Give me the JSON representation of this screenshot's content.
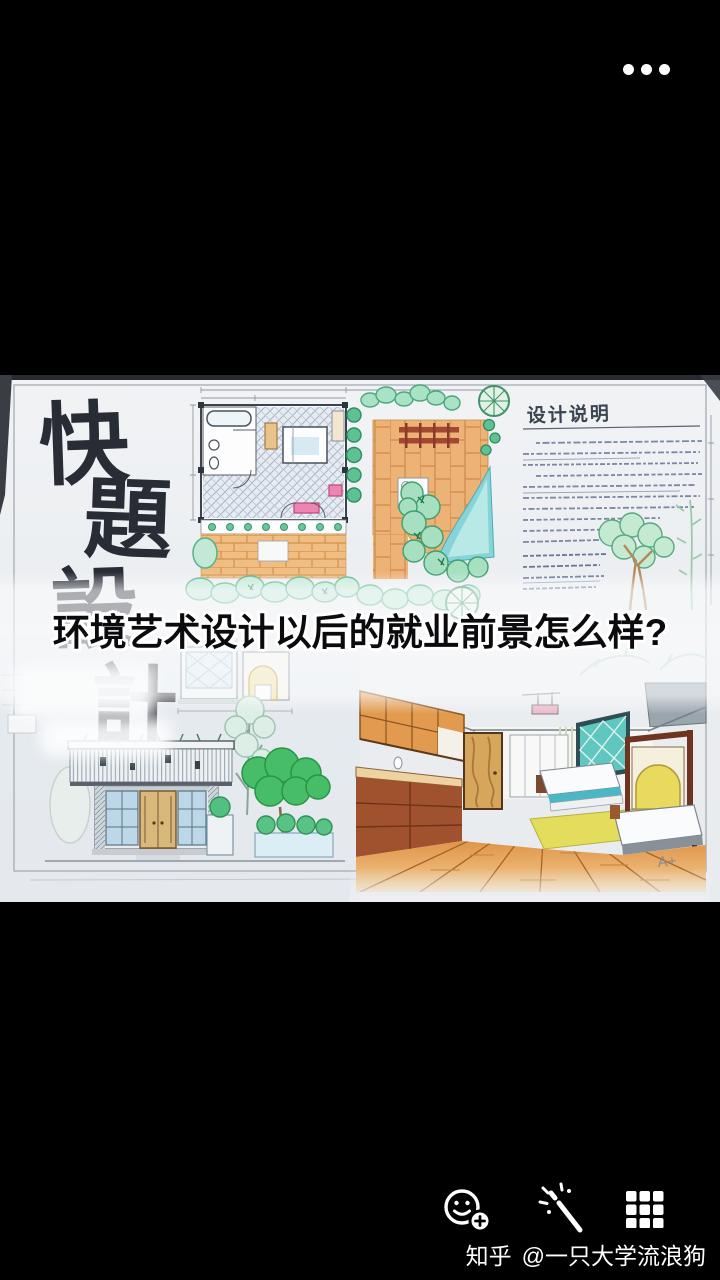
{
  "screen": {
    "background": "#000000"
  },
  "top_bar": {
    "more_menu_icon": "three-dots"
  },
  "question_overlay": {
    "text": "环境艺术设计以后的就业前景怎么样?",
    "text_color": "#0b0b0d",
    "halo_color": "#ffffff"
  },
  "sketch": {
    "calligraphy": [
      "快",
      "題",
      "設",
      "計"
    ],
    "notes_title": "设计说明",
    "signature": "A+",
    "colors": {
      "paper": "#eceef1",
      "ink": "#272c35",
      "brick": "#eeb87c",
      "water": "#86d4d8",
      "foliage": "#58c18e",
      "wood": "#d6a65c",
      "pergola_red": "#a34632",
      "interior_yellow": "#e3dc55",
      "window_teal": "#5fc6c0"
    }
  },
  "toolbar": {
    "icons": [
      "add-sticker",
      "magic-wand",
      "grid-layout"
    ]
  },
  "watermark": {
    "brand": "知乎",
    "author": "@一只大学流浪狗"
  }
}
